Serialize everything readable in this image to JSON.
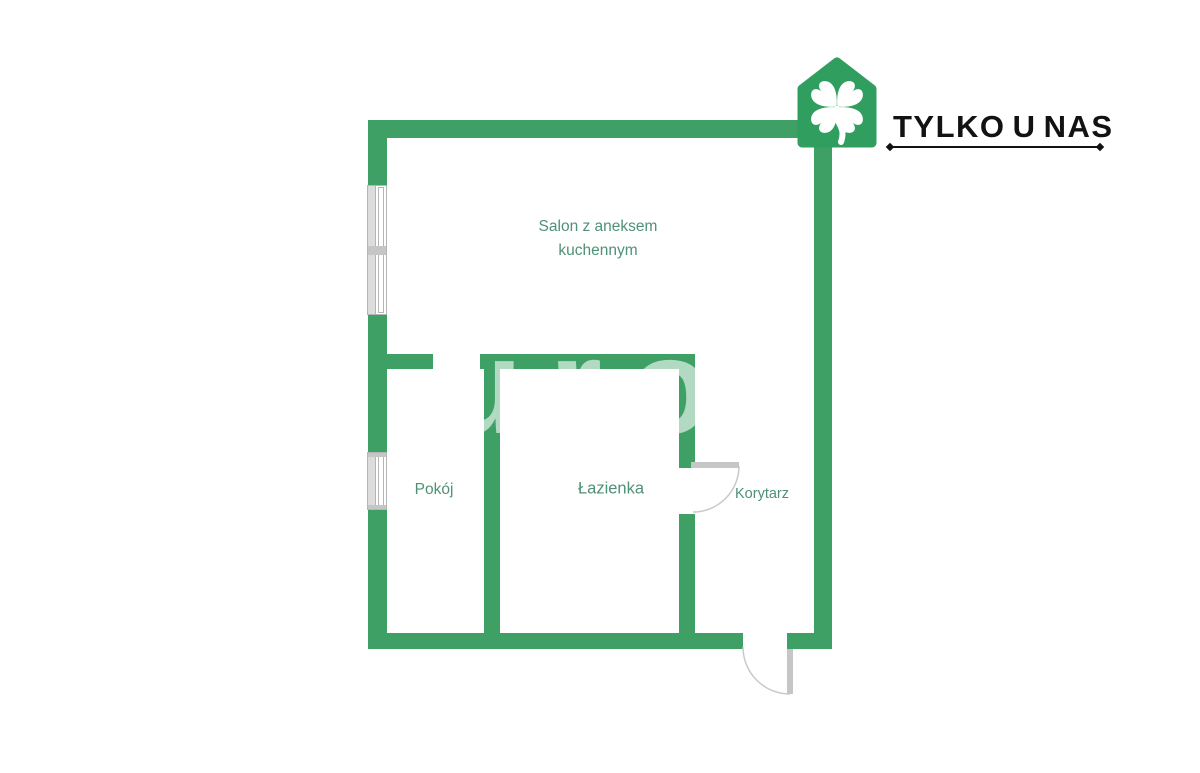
{
  "brand": {
    "name": "TYLKO U NAS",
    "logo_icon": "green-house-with-four-leaf-clover"
  },
  "rooms": {
    "salon": {
      "label": "Salon z aneksem kuchennym"
    },
    "pokoj": {
      "label": "Pokój"
    },
    "lazienka": {
      "label": "Łazienka"
    },
    "korytarz": {
      "label": "Korytarz"
    }
  },
  "watermark": {
    "text": "urov"
  },
  "colors": {
    "wall": "#3FA066",
    "logo": "#2F9E5F",
    "label": "#4E9176",
    "fixture": "#C6C6C6",
    "fixture-light": "#DCDCDC",
    "brand-text": "#121212",
    "bg": "#FFFFFF"
  }
}
